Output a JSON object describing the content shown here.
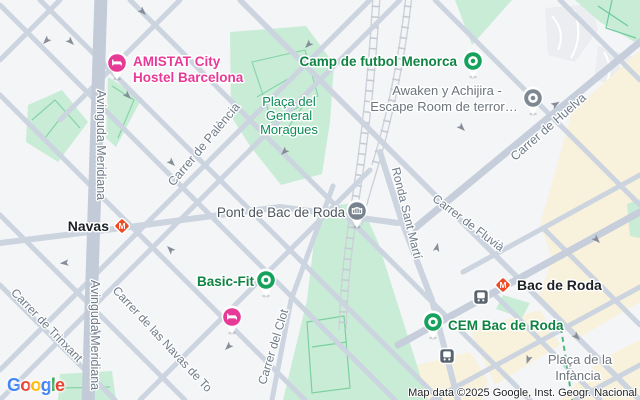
{
  "attribution": "Map data ©2025 Google, Inst. Geogr. Nacional",
  "logo_letters": [
    "G",
    "o",
    "o",
    "g",
    "l",
    "e"
  ],
  "streets": {
    "meridiana": "Avinguda Meridiana",
    "palencia": "Carrer de Palència",
    "trinxant": "Carrer de Trinxant",
    "navas_tolosa": "Carrer de las Navas de To",
    "clot": "Carrer del Clot",
    "ronda_sant_marti": "Ronda Sant Martí",
    "fluvia": "Carrer de Fluvià",
    "huelva": "Carrer de Huelva"
  },
  "places": {
    "amistat": {
      "line1": "AMISTAT City",
      "line2": "Hostel Barcelona"
    },
    "camp_futbol": "Camp de futbol Menorca",
    "awaken": {
      "line1": "Awaken y Achijira -",
      "line2": "Escape Room de terror…"
    },
    "moragues": {
      "line1": "Plaça del",
      "line2": "General",
      "line3": "Moragues"
    },
    "pont_bac_de_roda": "Pont de Bac de Roda",
    "navas_station": "Navas",
    "basic_fit": "Basic-Fit",
    "bac_de_roda_station": "Bac de Roda",
    "cem_bac_de_roda": "CEM Bac de Roda",
    "infancia": {
      "line1": "Plaça de la",
      "line2": "Infància"
    }
  },
  "icons": {
    "metro_glyph": "M"
  },
  "colors": {
    "road": "#cbd4df",
    "major_road": "#c2cbd7",
    "park_fill": "#c9ecd6",
    "park_path": "#86d4a8",
    "beige_block": "#f8f1dc",
    "poi_green_text": "#0f8342",
    "park_label_text": "#0d8a57",
    "gray_poi_text": "#6d747c",
    "street_label_text": "#6e7b89",
    "pink_poi": "#e73a96",
    "marker_green": "#16a15d",
    "marker_gray": "#7e8892",
    "metro_red": "#ee4a23",
    "bus_gray": "#5a646f",
    "logo_blue": "#4285F4",
    "logo_red": "#EA4335",
    "logo_yellow": "#FBBC05",
    "logo_green": "#34A853"
  }
}
